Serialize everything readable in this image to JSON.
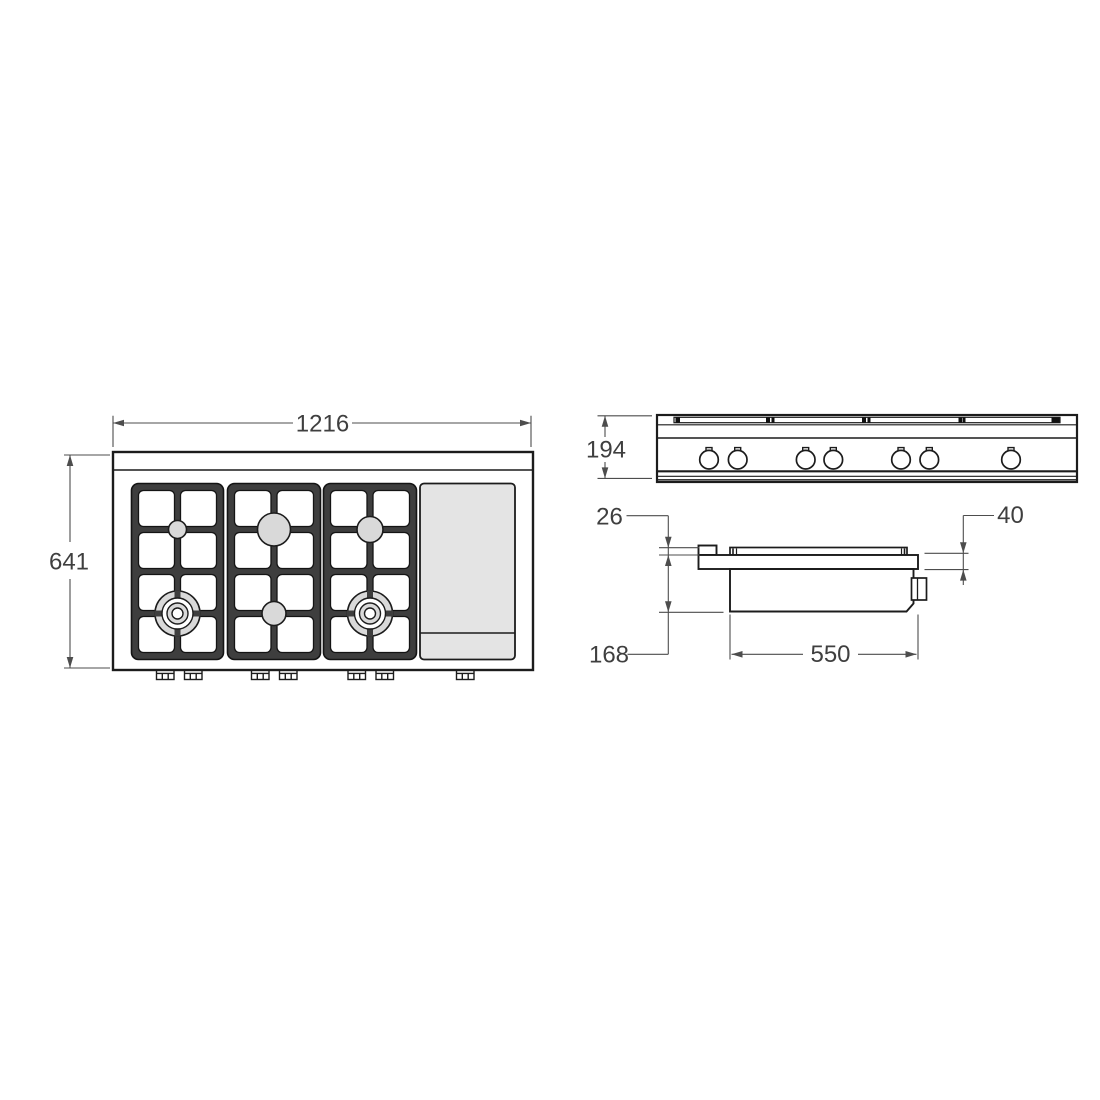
{
  "drawing": {
    "title": "Gas range top technical dimension drawing (plan, front and side views)",
    "labels": {
      "overall_width": "1216",
      "overall_depth": "641",
      "front_height": "194",
      "grate_above_top": "26",
      "top_above_counter": "40",
      "depth_below_top": "168",
      "body_depth": "550"
    },
    "colors": {
      "outline": "#1c1c1c",
      "dimension_line": "#4d4d4d",
      "dimension_text": "#3f3f3f",
      "grate_fill": "#3e3e3e",
      "burner_fill": "#d9d9d9",
      "griddle_fill": "#e4e4e4"
    }
  }
}
